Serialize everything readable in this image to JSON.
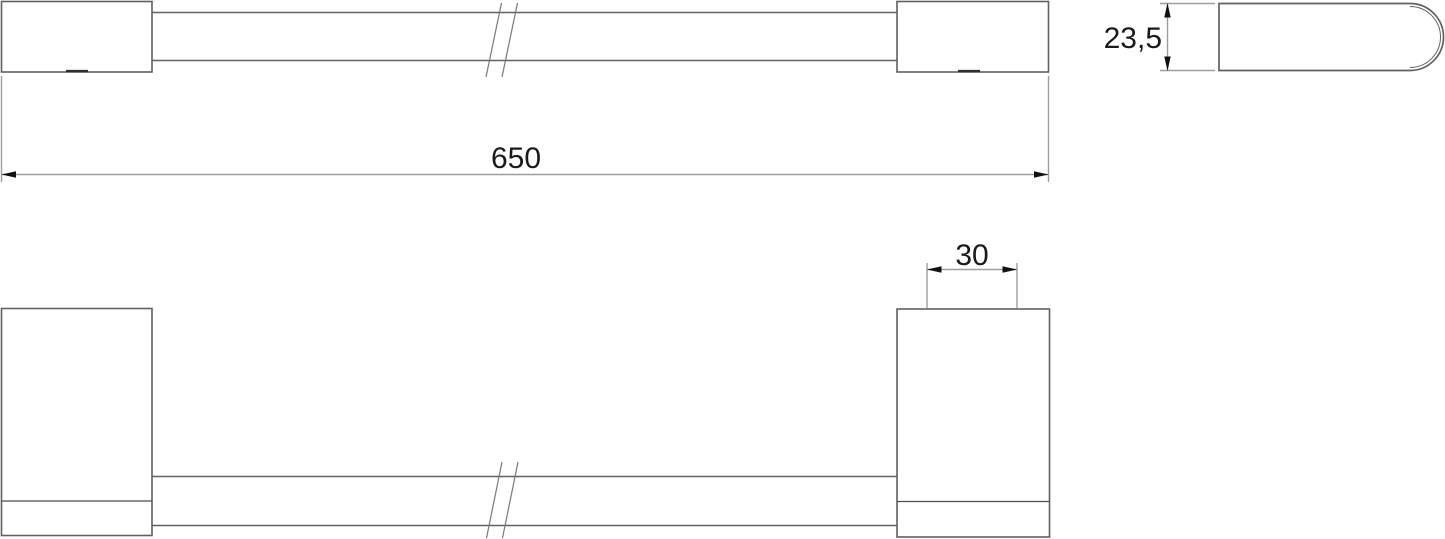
{
  "page": {
    "background": "#ffffff",
    "description": "technical dimension drawing of a wall-mounted towel bar, three views with break symbols"
  },
  "colors": {
    "outline": "#616161",
    "outline_dark": "#2e2e2e",
    "detail_line": "#4c4c4c",
    "break_line": "#7a7a7a",
    "dimension_line": "#9e9e9e",
    "arrow": "#111111",
    "text": "#1a1a1a"
  },
  "views": {
    "front": {
      "name": "front-elevation-view",
      "dimension": {
        "label": "650"
      }
    },
    "side": {
      "name": "side-profile-view",
      "dimension": {
        "label": "23,5"
      }
    },
    "plan": {
      "name": "plan-top-view",
      "dimension": {
        "label": "30"
      }
    }
  }
}
